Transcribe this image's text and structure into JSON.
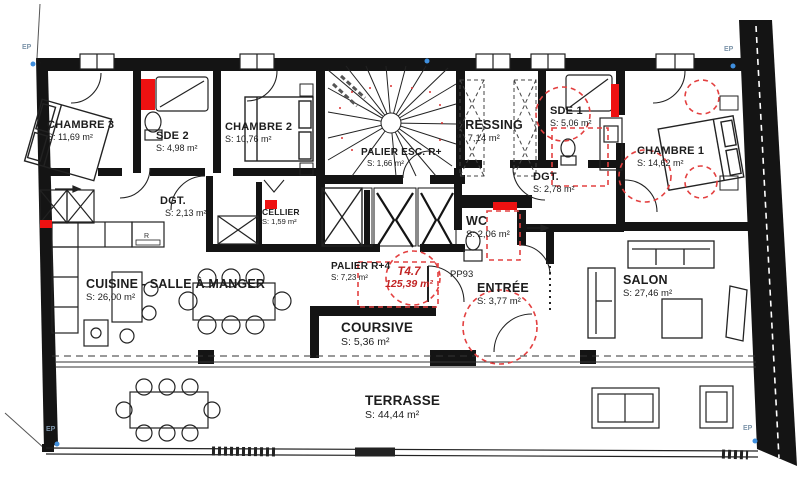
{
  "plan": {
    "unit": {
      "code": "T4.7",
      "area": "125,39 m²"
    },
    "door_ref": "PP93",
    "ep": "EP",
    "appliance_r": "R",
    "rooms": [
      {
        "id": "chambre3",
        "name": "CHAMBRE 3",
        "area": "S: 11,69 m²"
      },
      {
        "id": "sde2",
        "name": "SDE 2",
        "area": "S: 4,98 m²"
      },
      {
        "id": "chambre2",
        "name": "CHAMBRE 2",
        "area": "S: 10,76 m²"
      },
      {
        "id": "palieresc",
        "name": "PALIER ESC. R+",
        "area": "S: 1,66 m²"
      },
      {
        "id": "dressing",
        "name": "DRESSING",
        "area": "S: 7,14 m²"
      },
      {
        "id": "sde1",
        "name": "SDE 1",
        "area": "S: 5,06 m²"
      },
      {
        "id": "chambre1",
        "name": "CHAMBRE 1",
        "area": "S: 14,62 m²"
      },
      {
        "id": "dgt-left",
        "name": "DGT.",
        "area": "S: 2,13 m²"
      },
      {
        "id": "cellier",
        "name": "CELLIER",
        "area": "S: 1,59 m²"
      },
      {
        "id": "dgt-right",
        "name": "DGT.",
        "area": "S: 2,78 m²"
      },
      {
        "id": "wc",
        "name": "WC",
        "area": "S: 2,06 m²"
      },
      {
        "id": "cuisine",
        "name": "CUISINE - SALLE À MANGER",
        "area": "S: 26,00 m²"
      },
      {
        "id": "palier-r4",
        "name": "PALIER R+4",
        "area": "S: 7,23 m²"
      },
      {
        "id": "entree",
        "name": "ENTRÉE",
        "area": "S: 3,77 m²"
      },
      {
        "id": "salon",
        "name": "SALON",
        "area": "S: 27,46 m²"
      },
      {
        "id": "coursive",
        "name": "COURSIVE",
        "area": "S: 5,36 m²"
      },
      {
        "id": "terrasse",
        "name": "TERRASSE",
        "area": "S: 44,44 m²"
      }
    ]
  },
  "colors": {
    "wall": "#141414",
    "red_marker": "#ee1111",
    "red_annotation": "#e34040",
    "blue_dot": "#3f8fde"
  }
}
